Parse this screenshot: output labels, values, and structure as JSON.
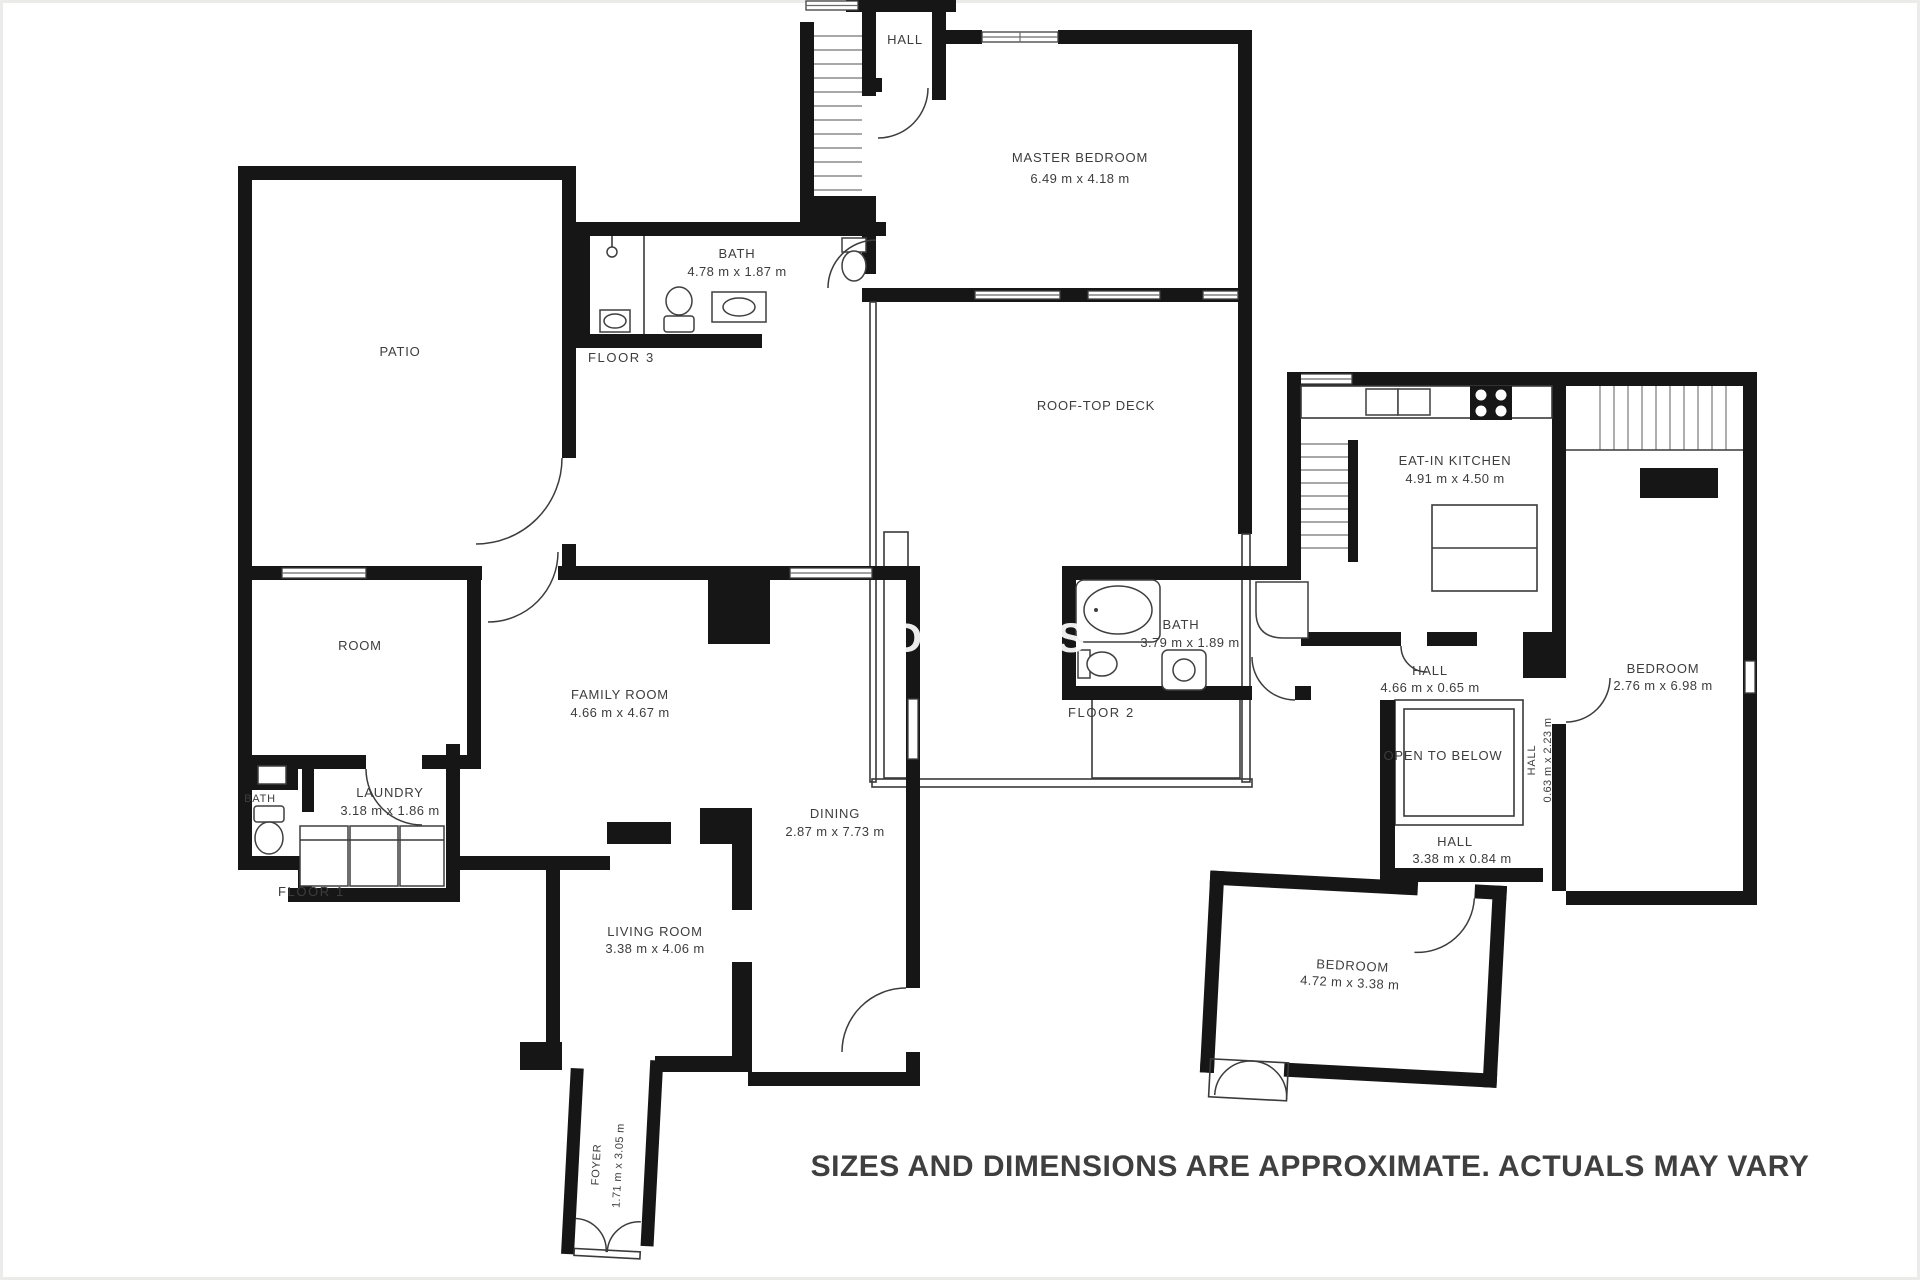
{
  "disclaimer": "SIZES AND DIMENSIONS ARE APPROXIMATE. ACTUALS MAY VARY",
  "watermark": {
    "letter1": "D",
    "letter2": "S"
  },
  "floor3": {
    "tag": "FLOOR 3",
    "hall_label": "HALL",
    "master_bedroom_label": "MASTER BEDROOM",
    "master_bedroom_dims": "6.49 m x 4.18 m",
    "bath_label": "BATH",
    "bath_dims": "4.78 m x 1.87 m",
    "roof_deck_label": "ROOF-TOP DECK"
  },
  "floor1": {
    "tag": "FLOOR 1",
    "patio_label": "PATIO",
    "room_label": "ROOM",
    "family_room_label": "FAMILY ROOM",
    "family_room_dims": "4.66 m x 4.67 m",
    "bath_label": "BATH",
    "laundry_label": "LAUNDRY",
    "laundry_dims": "3.18 m x 1.86 m",
    "dining_label": "DINING",
    "dining_dims": "2.87 m x 7.73 m",
    "living_room_label": "LIVING ROOM",
    "living_room_dims": "3.38 m x 4.06 m",
    "foyer_label": "FOYER",
    "foyer_dims": "1.71 m x 3.05 m"
  },
  "floor2": {
    "tag": "FLOOR 2",
    "kitchen_label": "EAT-IN KITCHEN",
    "kitchen_dims": "4.91 m x 4.50 m",
    "bath_label": "BATH",
    "bath_dims": "3.79 m x 1.89 m",
    "hall_upper_label": "HALL",
    "hall_upper_dims": "4.66 m x 0.65 m",
    "bedroom_right_label": "BEDROOM",
    "bedroom_right_dims": "2.76 m x 6.98 m",
    "open_below_label": "OPEN TO BELOW",
    "hall_vertical_label": "HALL",
    "hall_vertical_dims": "0.63 m x 2.23 m",
    "hall_lower_label": "HALL",
    "hall_lower_dims": "3.38 m x 0.84 m",
    "bedroom_bottom_label": "BEDROOM",
    "bedroom_bottom_dims": "4.72 m x 3.38 m"
  }
}
